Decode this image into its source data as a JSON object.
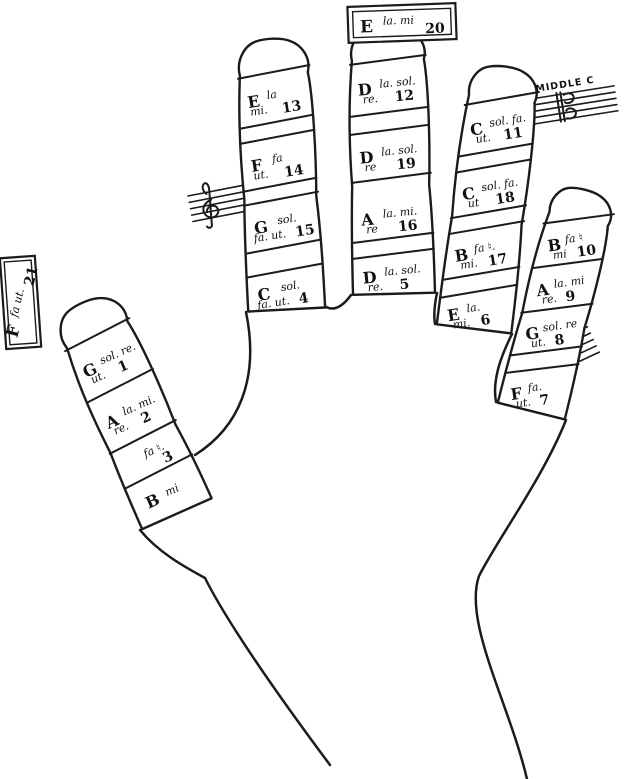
{
  "figure": {
    "description": "Guidonian hand solmization diagram (left hand, palm up) with numbered note-name joints",
    "background": "#ffffff",
    "ink": "#1b1b1b"
  },
  "boxes": {
    "tip_box": {
      "letter": "E",
      "syllables": "la. mi",
      "number": "20"
    },
    "side_box": {
      "letter": "F",
      "syllables": "fa ut.",
      "number": "21"
    }
  },
  "annotations": {
    "middle_c": "MIDDLE C"
  },
  "icons": {
    "g_clef": "treble-clef",
    "c_clef": "c-clef",
    "f_clef": "bass-clef"
  },
  "fingers": {
    "thumb": {
      "segments": [
        {
          "letter": "G",
          "syll1": "sol. re.",
          "syll2": "ut.",
          "num": "1"
        },
        {
          "letter": "A",
          "syll1": "la. mi.",
          "syll2": "re.",
          "num": "2"
        },
        {
          "letter": "",
          "syll1": "fa ♮.",
          "syll2": "",
          "num": "3"
        },
        {
          "letter": "B",
          "syll1": "mi",
          "syll2": "",
          "num": ""
        }
      ]
    },
    "index": {
      "segments": [
        {
          "letter": "E",
          "syll1": "la",
          "syll2": "mi.",
          "num": "13"
        },
        {
          "letter": "F",
          "syll1": "fa",
          "syll2": "ut.",
          "num": "14"
        },
        {
          "letter": "G",
          "syll1": "sol.",
          "syll2": "fa. ut.",
          "num": "15"
        },
        {
          "letter": "C",
          "syll1": "sol.",
          "syll2": "fa. ut.",
          "num": "4"
        }
      ]
    },
    "middle": {
      "segments": [
        {
          "letter": "D",
          "syll1": "la. sol.",
          "syll2": "re.",
          "num": "12"
        },
        {
          "letter": "D",
          "syll1": "la. sol.",
          "syll2": "re",
          "num": "19"
        },
        {
          "letter": "A",
          "syll1": "la. mi.",
          "syll2": "re",
          "num": "16"
        },
        {
          "letter": "D",
          "syll1": "la. sol.",
          "syll2": "re.",
          "num": "5"
        }
      ]
    },
    "ring": {
      "segments": [
        {
          "letter": "C",
          "syll1": "sol. fa.",
          "syll2": "ut.",
          "num": "11"
        },
        {
          "letter": "C",
          "syll1": "sol. fa.",
          "syll2": "ut",
          "num": "18"
        },
        {
          "letter": "B",
          "syll1": "fa ♮.",
          "syll2": "mi.",
          "num": "17"
        },
        {
          "letter": "E",
          "syll1": "la.",
          "syll2": "mi.",
          "num": "6"
        }
      ]
    },
    "little": {
      "segments": [
        {
          "letter": "B",
          "syll1": "fa ♮",
          "syll2": "mi",
          "num": "10"
        },
        {
          "letter": "A",
          "syll1": "la. mi",
          "syll2": "re.",
          "num": "9"
        },
        {
          "letter": "G",
          "syll1": "sol. re",
          "syll2": "ut.",
          "num": "8"
        },
        {
          "letter": "F",
          "syll1": "fa.",
          "syll2": "ut.",
          "num": "7"
        }
      ]
    }
  }
}
